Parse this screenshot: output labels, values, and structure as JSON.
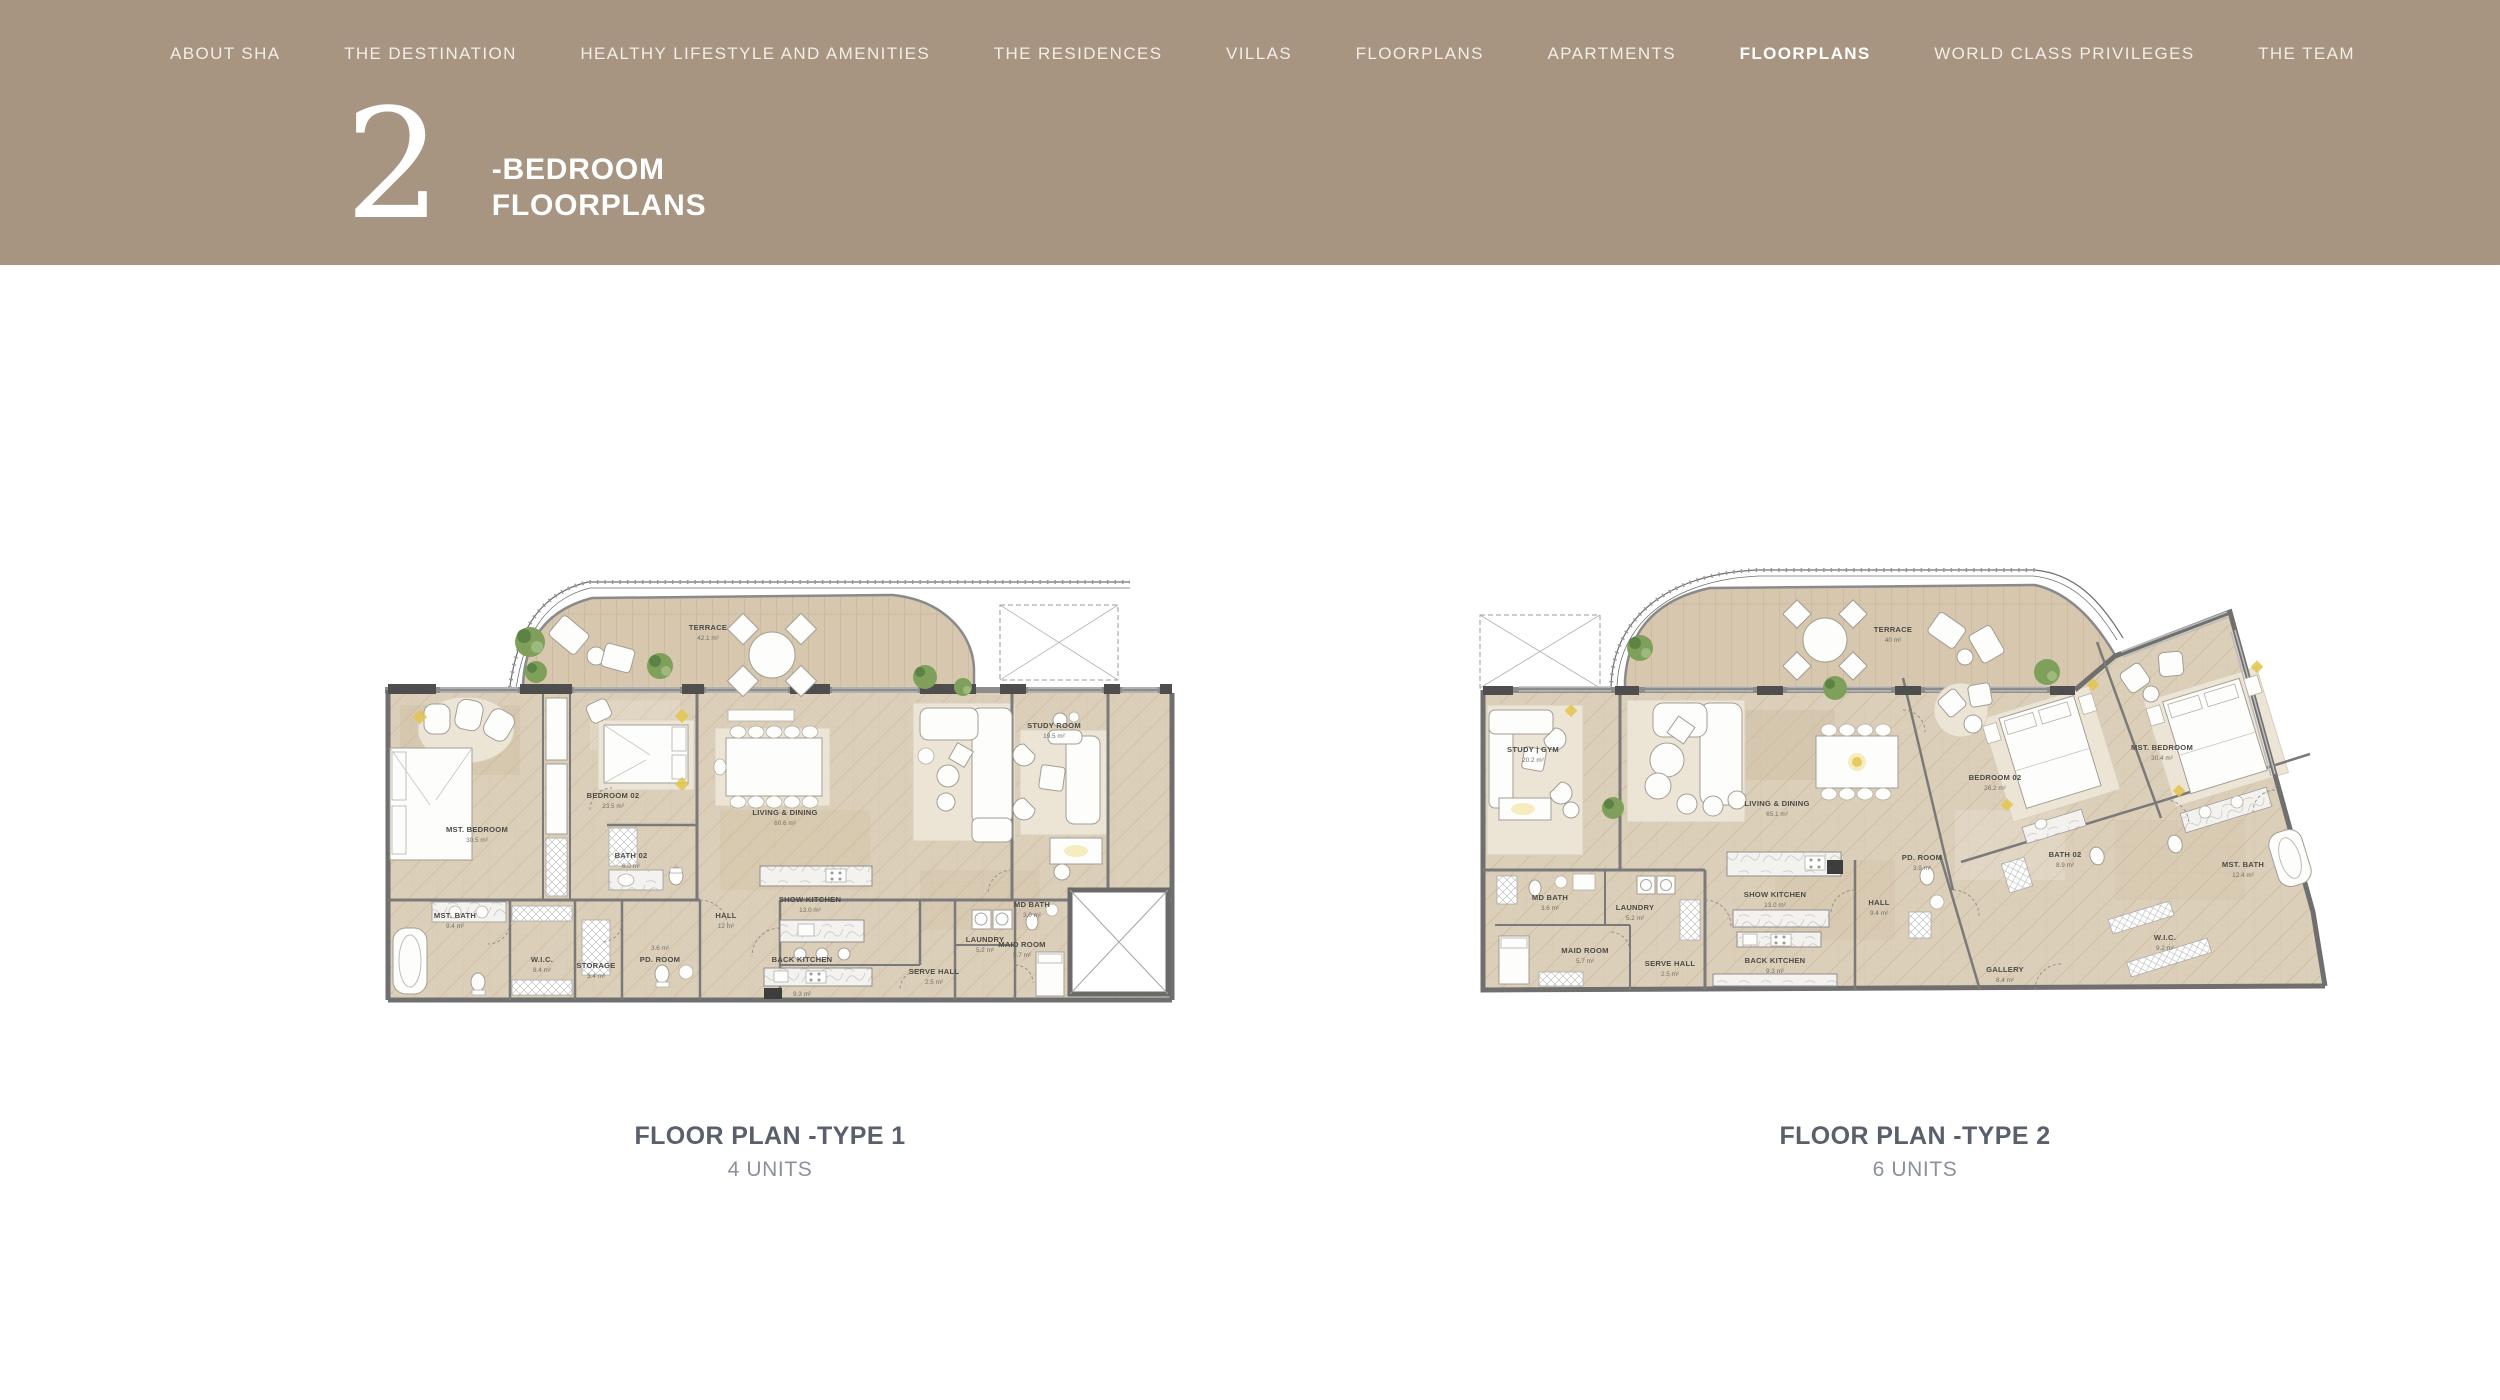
{
  "header": {
    "nav": {
      "items": [
        {
          "label": "ABOUT SHA",
          "active": false
        },
        {
          "label": "THE DESTINATION",
          "active": false
        },
        {
          "label": "HEALTHY LIFESTYLE AND AMENITIES",
          "active": false
        },
        {
          "label": "THE  RESIDENCES",
          "active": false
        },
        {
          "label": "VILLAS",
          "active": false
        },
        {
          "label": "FLOORPLANS",
          "active": false
        },
        {
          "label": "APARTMENTS",
          "active": false
        },
        {
          "label": "FLOORPLANS",
          "active": true
        },
        {
          "label": "WORLD CLASS PRIVILEGES",
          "active": false
        },
        {
          "label": "THE TEAM",
          "active": false
        }
      ]
    },
    "title": {
      "number": "2",
      "line1": "-BEDROOM",
      "line2": "FLOORPLANS"
    }
  },
  "plans": [
    {
      "caption": "FLOOR PLAN -TYPE 1",
      "units": "4 UNITS",
      "rooms": [
        {
          "name": "TERRACE",
          "area": "42.1 m²"
        },
        {
          "name": "MST. BEDROOM",
          "area": "30.5 m²"
        },
        {
          "name": "BEDROOM 02",
          "area": "23.5 m²"
        },
        {
          "name": "BATH 02",
          "area": "6.0 m²"
        },
        {
          "name": "LIVING & DINING",
          "area": "60.6 m²"
        },
        {
          "name": "STUDY ROOM",
          "area": "19.5 m²"
        },
        {
          "name": "MST. BATH",
          "area": "9.4 m²"
        },
        {
          "name": "W.I.C.",
          "area": "8.4 m²"
        },
        {
          "name": "STORAGE",
          "area": "3.4 m²"
        },
        {
          "name": "PD. ROOM",
          "area": "3.6 m²"
        },
        {
          "name": "HALL",
          "area": "12 m²"
        },
        {
          "name": "SHOW KITCHEN",
          "area": "13.0 m²"
        },
        {
          "name": "BACK KITCHEN",
          "area": "9.3 m²"
        },
        {
          "name": "SERVE HALL",
          "area": "2.5 m²"
        },
        {
          "name": "LAUNDRY",
          "area": "5.2 m²"
        },
        {
          "name": "MD BATH",
          "area": "3.0 m²"
        },
        {
          "name": "MAID ROOM",
          "area": "5.7 m²"
        }
      ]
    },
    {
      "caption": "FLOOR PLAN -TYPE 2",
      "units": "6 UNITS",
      "rooms": [
        {
          "name": "TERRACE",
          "area": "40 m²"
        },
        {
          "name": "STUDY | GYM",
          "area": "20.2 m²"
        },
        {
          "name": "LIVING & DINING",
          "area": "65.1 m²"
        },
        {
          "name": "BEDROOM 02",
          "area": "26.2 m²"
        },
        {
          "name": "MST. BEDROOM",
          "area": "30.4 m²"
        },
        {
          "name": "BATH 02",
          "area": "8.9 m²"
        },
        {
          "name": "MST. BATH",
          "area": "12.4 m²"
        },
        {
          "name": "W.I.C.",
          "area": "9.2 m²"
        },
        {
          "name": "PD. ROOM",
          "area": "3.9 m²"
        },
        {
          "name": "HALL",
          "area": "9.4 m²"
        },
        {
          "name": "SHOW KITCHEN",
          "area": "13.0 m²"
        },
        {
          "name": "BACK KITCHEN",
          "area": "9.3 m²"
        },
        {
          "name": "SERVE HALL",
          "area": "2.5 m²"
        },
        {
          "name": "LAUNDRY",
          "area": "5.2 m²"
        },
        {
          "name": "MD BATH",
          "area": "3.6 m²"
        },
        {
          "name": "MAID ROOM",
          "area": "5.7 m²"
        },
        {
          "name": "GALLERY",
          "area": "8.4 m²"
        }
      ]
    }
  ],
  "colors": {
    "header_bg": "#a79582",
    "caption_text": "#59606b",
    "units_text": "#8b919b",
    "floor_wood": "#dbceb8",
    "terrace_wood": "#d6c7ae",
    "wall": "#6f6f6f",
    "lamp_accent": "#e3c44e",
    "plant_green": "#7fa05b"
  }
}
